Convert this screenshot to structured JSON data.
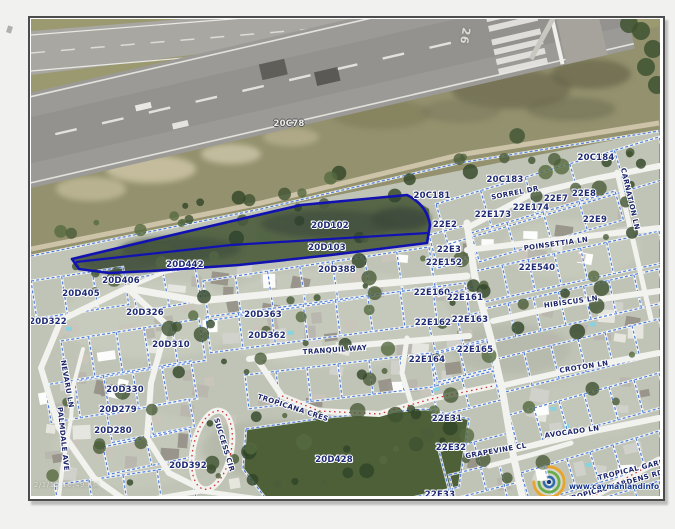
{
  "map": {
    "runway_label": "26",
    "timestamp": "2/1/11 10:49 AM",
    "watermark_url": "www.caymanlandinfo.ky",
    "highlighted_parcels": [
      "20D102",
      "20D103"
    ],
    "colors": {
      "parcel_line": "#4f7fdc",
      "highlight_outline": "#1212b2",
      "label_text": "#1e2a73",
      "road": "#f2f2ee"
    },
    "parcel_labels": [
      {
        "id": "20C78",
        "x": 258,
        "y": 105,
        "light": true
      },
      {
        "id": "20C181",
        "x": 401,
        "y": 177
      },
      {
        "id": "20C183",
        "x": 474,
        "y": 161
      },
      {
        "id": "20C184",
        "x": 565,
        "y": 139
      },
      {
        "id": "20D102",
        "x": 299,
        "y": 207
      },
      {
        "id": "20D103",
        "x": 296,
        "y": 229
      },
      {
        "id": "20D442",
        "x": 154,
        "y": 246
      },
      {
        "id": "20D406",
        "x": 90,
        "y": 262
      },
      {
        "id": "20D405",
        "x": 50,
        "y": 275
      },
      {
        "id": "20D388",
        "x": 306,
        "y": 251
      },
      {
        "id": "20D326",
        "x": 114,
        "y": 294
      },
      {
        "id": "20D322",
        "x": 17,
        "y": 303
      },
      {
        "id": "20D310",
        "x": 140,
        "y": 326
      },
      {
        "id": "20D363",
        "x": 232,
        "y": 296
      },
      {
        "id": "20D362",
        "x": 236,
        "y": 317
      },
      {
        "id": "20D330",
        "x": 94,
        "y": 371
      },
      {
        "id": "20D279",
        "x": 87,
        "y": 391
      },
      {
        "id": "20D280",
        "x": 82,
        "y": 412
      },
      {
        "id": "20D392",
        "x": 157,
        "y": 447
      },
      {
        "id": "20D428",
        "x": 303,
        "y": 441
      },
      {
        "id": "22E2",
        "x": 414,
        "y": 206
      },
      {
        "id": "22E3",
        "x": 418,
        "y": 231
      },
      {
        "id": "22E152",
        "x": 413,
        "y": 244
      },
      {
        "id": "22E160",
        "x": 401,
        "y": 274
      },
      {
        "id": "22E161",
        "x": 434,
        "y": 279
      },
      {
        "id": "22E162",
        "x": 402,
        "y": 304
      },
      {
        "id": "22E163",
        "x": 439,
        "y": 301
      },
      {
        "id": "22E164",
        "x": 396,
        "y": 341
      },
      {
        "id": "22E165",
        "x": 444,
        "y": 331
      },
      {
        "id": "22E173",
        "x": 462,
        "y": 196
      },
      {
        "id": "22E174",
        "x": 500,
        "y": 189
      },
      {
        "id": "22E7",
        "x": 525,
        "y": 180
      },
      {
        "id": "22E8",
        "x": 553,
        "y": 175
      },
      {
        "id": "22E9",
        "x": 564,
        "y": 201
      },
      {
        "id": "22E540",
        "x": 506,
        "y": 249
      },
      {
        "id": "22E31",
        "x": 416,
        "y": 400
      },
      {
        "id": "22E32",
        "x": 420,
        "y": 429
      },
      {
        "id": "22E33",
        "x": 409,
        "y": 476
      }
    ],
    "street_labels": [
      {
        "name": "SORREL DR",
        "x": 484,
        "y": 174,
        "rot": -11
      },
      {
        "name": "POINSETTIA LN",
        "x": 525,
        "y": 225,
        "rot": -8
      },
      {
        "name": "HIBISCUS LN",
        "x": 540,
        "y": 283,
        "rot": -8
      },
      {
        "name": "CROTON LN",
        "x": 553,
        "y": 348,
        "rot": -9
      },
      {
        "name": "AVOCADO LN",
        "x": 541,
        "y": 413,
        "rot": -8
      },
      {
        "name": "GRAPEVINE CL",
        "x": 465,
        "y": 432,
        "rot": -10
      },
      {
        "name": "CARNATION LN",
        "x": 599,
        "y": 180,
        "rot": 77
      },
      {
        "name": "TRANQUIL WAY",
        "x": 304,
        "y": 331,
        "rot": -4
      },
      {
        "name": "TROPICANA CRES",
        "x": 262,
        "y": 389,
        "rot": 18
      },
      {
        "name": "SUCCESS CIR",
        "x": 193,
        "y": 426,
        "rot": 73
      },
      {
        "name": "NEVARU LN",
        "x": 36,
        "y": 365,
        "rot": 80
      },
      {
        "name": "PALMDALE AVE",
        "x": 32,
        "y": 420,
        "rot": 84
      },
      {
        "name": "TROPICAL GARDENS RD",
        "x": 584,
        "y": 467,
        "rot": -16
      },
      {
        "name": "TROPICAL GARDENS RD",
        "x": 616,
        "y": 447,
        "rot": -14
      }
    ]
  }
}
